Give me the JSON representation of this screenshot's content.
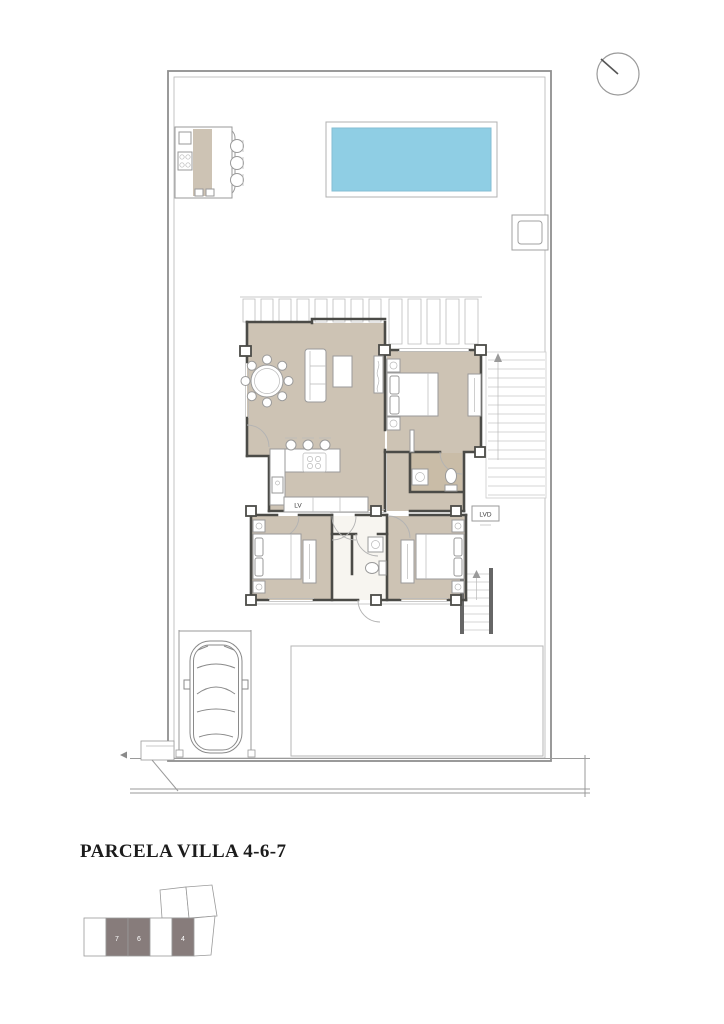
{
  "title": "PARCELA VILLA 4-6-7",
  "labels": {
    "dishwasher": "LV",
    "laundry": "LVD"
  },
  "keyplan": {
    "units": [
      "7",
      "6",
      "4"
    ]
  },
  "compass": {
    "needle_direction": "north-west"
  },
  "colors": {
    "floor": "#cdc3b4",
    "bath_floor": "#c9bca7",
    "pool": "#8fcee4",
    "keyplan_dark": "#877c7b",
    "wall": "#4b4b47",
    "line": "#9a9a9a"
  }
}
